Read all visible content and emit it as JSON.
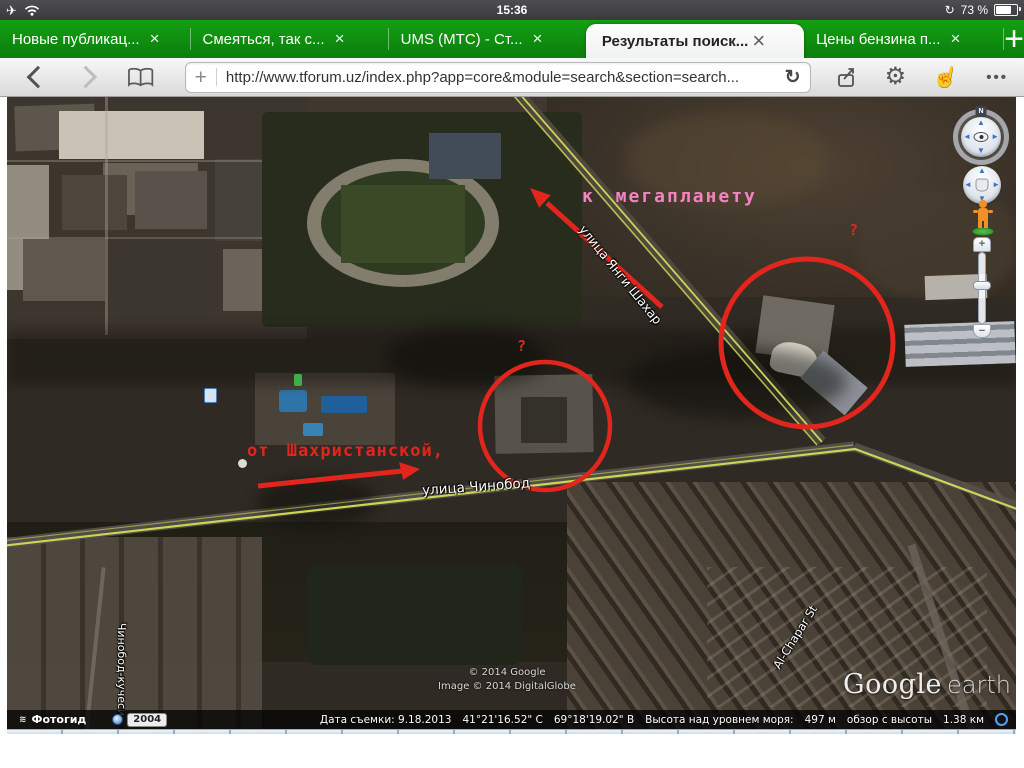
{
  "status_bar": {
    "time": "15:36",
    "battery_percent": "73 %"
  },
  "icons": {
    "airplane": "✈",
    "rotation_lock": "↻",
    "add_bookmark": "+",
    "reload": "↻",
    "gear": "⚙",
    "pointer": "☝",
    "ellipsis": "•••",
    "new_tab": "+",
    "close": "×",
    "compass_north": "N",
    "photo_guide_glyph": "≋",
    "zoom_in": "+",
    "zoom_out": "−"
  },
  "tab_bar": {
    "tabs": [
      {
        "label": "Новые публикац...",
        "close": "×"
      },
      {
        "label": "Смеяться, так с...",
        "close": "×"
      },
      {
        "label": "UMS (МТС) - Ст...",
        "close": "×"
      },
      {
        "label": "Результаты поиск...",
        "close": "×"
      },
      {
        "label": "Цены бензина п...",
        "close": "×"
      }
    ]
  },
  "toolbar": {
    "url": "http://www.tforum.uz/index.php?app=core&module=search&section=search..."
  },
  "map": {
    "annotations": {
      "direction_note_top": "к мегапланету",
      "direction_note_left": "от Шахристанской,",
      "question_mark_right": "?",
      "question_mark_center": "?"
    },
    "street_labels": {
      "yangi_shahar": "улица Янги Шахар",
      "chinobod": "улица Чинобод",
      "al_chapar": "Al-Chapar St",
      "chinobod_kuchesi": "Чинобод-кучеси"
    },
    "attribution_line1": "© 2014 Google",
    "attribution_line2": "Image © 2014 DigitalGlobe",
    "logo_google": "Google",
    "logo_earth": "earth",
    "statusbar": {
      "photo_guide": "Фотогид",
      "timeline_year": "2004",
      "capture_date": "Дата съемки: 9.18.2013",
      "latitude": "41°21'16.52\" С",
      "longitude": "69°18'19.02\" В",
      "elevation_label": "Высота над уровнем моря:",
      "elevation_value": "497 м",
      "eye_altitude_label": "обзор с высоты",
      "eye_altitude_value": "1.38 км"
    },
    "colors": {
      "annotation_red": "#e3261d",
      "annotation_pink": "#f583c0",
      "road_yellow": "#cbd556",
      "tab_green": "#0f8f0f"
    }
  }
}
